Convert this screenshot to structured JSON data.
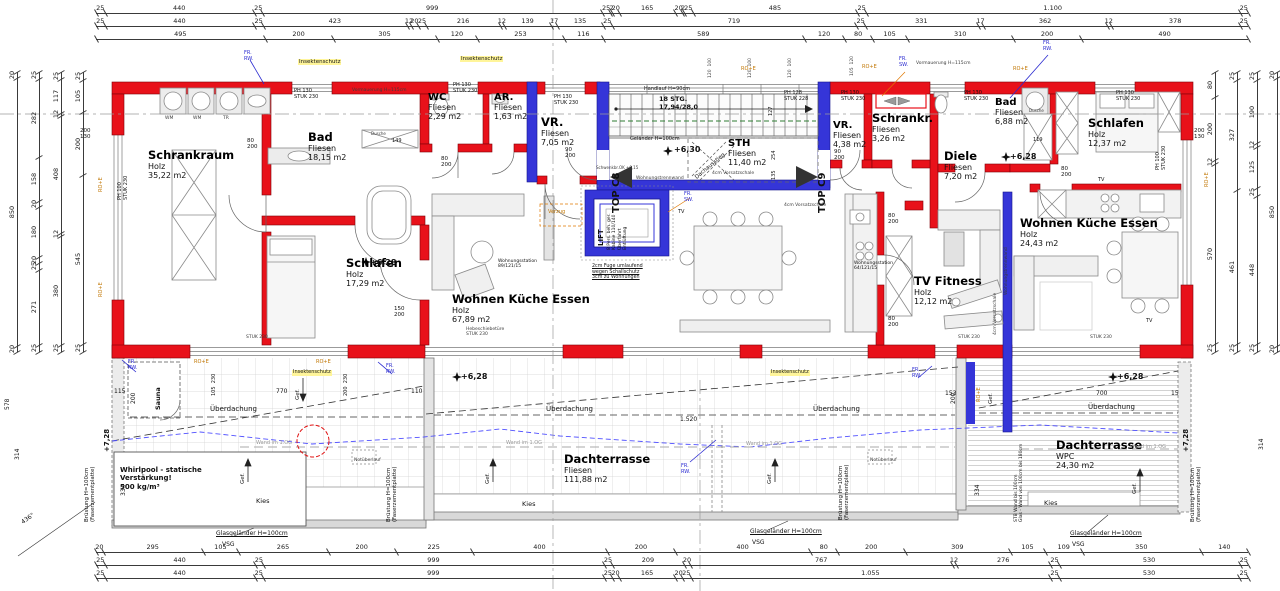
{
  "drawing": {
    "kind": "architectural floor plan",
    "units": [
      "TOP C8",
      "TOP C9"
    ]
  },
  "rooms": [
    {
      "name": "Schrankraum",
      "material": "Holz",
      "area": "35,22 m2",
      "x": 148,
      "y": 148
    },
    {
      "name": "Bad",
      "material": "Fliesen",
      "area": "18,15 m2",
      "x": 308,
      "y": 130
    },
    {
      "name": "WC",
      "material": "Fliesen",
      "area": "2,29 m2",
      "x": 428,
      "y": 92,
      "small": true
    },
    {
      "name": "AR.",
      "material": "Fliesen",
      "area": "1,63 m2",
      "x": 494,
      "y": 92,
      "small": true
    },
    {
      "name": "VR.",
      "material": "Fliesen",
      "area": "7,05 m2",
      "x": 541,
      "y": 115
    },
    {
      "name": "Schlafen",
      "material": "Holz",
      "area": "17,29 m2",
      "x": 346,
      "y": 256
    },
    {
      "name": "Wohnen Küche Essen",
      "material": "Holz",
      "area": "67,89 m2",
      "x": 452,
      "y": 292
    },
    {
      "name": "STH",
      "material": "Fliesen",
      "area": "11,40 m2",
      "x": 728,
      "y": 138,
      "small": true
    },
    {
      "name": "VR.",
      "material": "Fliesen",
      "area": "4,38 m2",
      "x": 833,
      "y": 120,
      "small": true
    },
    {
      "name": "Schrankr.",
      "material": "Fliesen",
      "area": "3,26 m2",
      "x": 872,
      "y": 111
    },
    {
      "name": "Bad",
      "material": "Fliesen",
      "area": "6,88 m2",
      "x": 995,
      "y": 97,
      "small": true
    },
    {
      "name": "Diele",
      "material": "Fliesen",
      "area": "7,20 m2",
      "x": 944,
      "y": 149
    },
    {
      "name": "Schlafen",
      "material": "Holz",
      "area": "12,37 m2",
      "x": 1088,
      "y": 116
    },
    {
      "name": "Wohnen Küche Essen",
      "material": "Holz",
      "area": "24,43 m2",
      "x": 1020,
      "y": 216
    },
    {
      "name": "TV Fitness",
      "material": "Holz",
      "area": "12,12 m2",
      "x": 914,
      "y": 274
    },
    {
      "name": "Dachterrasse",
      "material": "Fliesen",
      "area": "111,88 m2",
      "x": 564,
      "y": 452
    },
    {
      "name": "Dachterrasse",
      "material": "WPC",
      "area": "24,30 m2",
      "x": 1056,
      "y": 438
    }
  ],
  "labels": [
    {
      "t": "FR.\nRW.",
      "x": 244,
      "y": 51,
      "s": 5,
      "c": "blue"
    },
    {
      "t": "FR.\nRW.",
      "x": 1043,
      "y": 41,
      "s": 5,
      "c": "blue"
    },
    {
      "t": "FR.\nSW.",
      "x": 899,
      "y": 57,
      "s": 5,
      "c": "blue"
    },
    {
      "t": "FR.\nSW.",
      "x": 684,
      "y": 192,
      "s": 5,
      "c": "blue"
    },
    {
      "t": "RO+E",
      "x": 741,
      "y": 67,
      "s": 5,
      "c": "orange"
    },
    {
      "t": "RO+E",
      "x": 862,
      "y": 65,
      "s": 5,
      "c": "orange"
    },
    {
      "t": "RO+E",
      "x": 1013,
      "y": 67,
      "s": 5,
      "c": "orange"
    },
    {
      "t": "Insektenschutz",
      "x": 298,
      "y": 59,
      "s": 5.5,
      "c": "yellow"
    },
    {
      "t": "Insektenschutz",
      "x": 460,
      "y": 56,
      "s": 5.5,
      "c": "yellow"
    },
    {
      "t": "Vormauerung H=115cm",
      "x": 352,
      "y": 88,
      "s": 4.5,
      "c": "dim"
    },
    {
      "t": "Vormauerung H=115cm",
      "x": 916,
      "y": 61,
      "s": 4.5,
      "c": "dim"
    },
    {
      "t": "PH 130\nSTUK 230",
      "x": 294,
      "y": 89,
      "s": 5
    },
    {
      "t": "PH 130\nSTUK 230",
      "x": 453,
      "y": 83,
      "s": 5
    },
    {
      "t": "PH 130\nSTUK 230",
      "x": 554,
      "y": 95,
      "s": 5
    },
    {
      "t": "PH 128\nSTUK 228",
      "x": 784,
      "y": 91,
      "s": 5
    },
    {
      "t": "PH 130\nSTUK 230",
      "x": 841,
      "y": 91,
      "s": 5
    },
    {
      "t": "PH 130\nSTUK 230",
      "x": 964,
      "y": 91,
      "s": 5
    },
    {
      "t": "PH 130\nSTUK 230",
      "x": 1116,
      "y": 91,
      "s": 5
    },
    {
      "t": "PH 100\nSTUK 230",
      "x": 118,
      "y": 200,
      "r": -90,
      "s": 5
    },
    {
      "t": "PH 100\nSTUK 230",
      "x": 1156,
      "y": 170,
      "r": -90,
      "s": 5
    },
    {
      "t": "120  100",
      "x": 708,
      "y": 78,
      "r": -90,
      "s": 4.5,
      "c": "dim"
    },
    {
      "t": "120  100",
      "x": 748,
      "y": 78,
      "r": -90,
      "s": 4.5,
      "c": "dim"
    },
    {
      "t": "120  100",
      "x": 788,
      "y": 78,
      "r": -90,
      "s": 4.5,
      "c": "dim"
    },
    {
      "t": "105  120",
      "x": 850,
      "y": 76,
      "r": -90,
      "s": 4.5,
      "c": "dim"
    },
    {
      "t": "Handlauf H=90cm",
      "x": 644,
      "y": 87,
      "s": 5
    },
    {
      "t": "18 STG.\n17,94/28,0",
      "x": 659,
      "y": 96,
      "s": 6.5,
      "c": "bold"
    },
    {
      "t": "Geländer H=100cm",
      "x": 630,
      "y": 137,
      "s": 5
    },
    {
      "t": "+6,30",
      "x": 674,
      "y": 145,
      "s": 8,
      "c": "bold"
    },
    {
      "t": "TOP C8",
      "x": 611,
      "y": 213,
      "r": -90,
      "s": 10,
      "c": "bold"
    },
    {
      "t": "TOP C9",
      "x": 817,
      "y": 213,
      "r": -90,
      "s": 10,
      "c": "bold"
    },
    {
      "t": "127",
      "x": 769,
      "y": 116,
      "r": -90,
      "s": 5
    },
    {
      "t": "254",
      "x": 772,
      "y": 160,
      "r": -90,
      "s": 5
    },
    {
      "t": "135",
      "x": 772,
      "y": 180,
      "r": -90,
      "s": 5
    },
    {
      "t": "Dachausstieg",
      "x": 694,
      "y": 176,
      "r": -40,
      "s": 5.5
    },
    {
      "t": "Schwenkbr.OK +0,15",
      "x": 596,
      "y": 166,
      "s": 4,
      "c": "dim"
    },
    {
      "t": "LIFT",
      "x": 597,
      "y": 246,
      "r": -90,
      "s": 7,
      "c": "bold"
    },
    {
      "t": "8 Pers. beh. ger.\nKabine 110/140\nÜberfahrt\nEntlüftung",
      "x": 607,
      "y": 250,
      "r": -90,
      "s": 4.5
    },
    {
      "t": "2cm Fuge umlaufend\nwegen Schallschutz\n3cm zu Wohnungen",
      "x": 592,
      "y": 264,
      "s": 4.8,
      "c": "ul"
    },
    {
      "t": "Wohnungstrennwand",
      "x": 636,
      "y": 176,
      "s": 4.5,
      "c": "dim"
    },
    {
      "t": "Wohnungstrennwand",
      "x": 1004,
      "y": 295,
      "r": -90,
      "s": 4.5,
      "c": "dim"
    },
    {
      "t": "4cm Vorsatzschale",
      "x": 712,
      "y": 171,
      "s": 4.5,
      "c": "dim"
    },
    {
      "t": "4cm Vorsatzschale",
      "x": 784,
      "y": 203,
      "s": 4.5,
      "c": "dim"
    },
    {
      "t": "4cm Vorsatzschale",
      "x": 993,
      "y": 335,
      "r": -90,
      "s": 4.5,
      "c": "dim"
    },
    {
      "t": "Verzug",
      "x": 548,
      "y": 210,
      "s": 5,
      "c": "orange"
    },
    {
      "t": "TV",
      "x": 678,
      "y": 210,
      "s": 5
    },
    {
      "t": "TV",
      "x": 1098,
      "y": 178,
      "s": 5
    },
    {
      "t": "TV",
      "x": 1146,
      "y": 319,
      "s": 5
    },
    {
      "t": "Hebeschiebetüre\nSTUK 230",
      "x": 466,
      "y": 327,
      "s": 4.5,
      "c": "dim"
    },
    {
      "t": "STUK 230",
      "x": 246,
      "y": 335,
      "s": 4.5,
      "c": "dim"
    },
    {
      "t": "STUK 230",
      "x": 958,
      "y": 335,
      "s": 4.5,
      "c": "dim"
    },
    {
      "t": "STUK 230",
      "x": 1090,
      "y": 335,
      "s": 4.5,
      "c": "dim"
    },
    {
      "t": "Wohnungsstation\n89/121/15",
      "x": 498,
      "y": 259,
      "s": 4.5
    },
    {
      "t": "Wohnungsstation\n64/121/15",
      "x": 854,
      "y": 261,
      "s": 4.5
    },
    {
      "t": "Dusche",
      "x": 371,
      "y": 132,
      "s": 4,
      "c": "dim"
    },
    {
      "t": "149",
      "x": 392,
      "y": 139,
      "s": 5
    },
    {
      "t": "Dusche",
      "x": 1029,
      "y": 109,
      "s": 4,
      "c": "dim"
    },
    {
      "t": "119",
      "x": 1033,
      "y": 138,
      "s": 5
    },
    {
      "t": "80\n200",
      "x": 247,
      "y": 138,
      "s": 5.5
    },
    {
      "t": "80\n200",
      "x": 441,
      "y": 156,
      "s": 5.5
    },
    {
      "t": "90\n200",
      "x": 565,
      "y": 147,
      "s": 5.5
    },
    {
      "t": "90\n200",
      "x": 834,
      "y": 149,
      "s": 5.5
    },
    {
      "t": "80\n200",
      "x": 1061,
      "y": 166,
      "s": 5.5
    },
    {
      "t": "80\n200",
      "x": 888,
      "y": 213,
      "s": 5.5
    },
    {
      "t": "80\n200",
      "x": 888,
      "y": 316,
      "s": 5.5
    },
    {
      "t": "150\n200",
      "x": 394,
      "y": 306,
      "s": 5.5
    },
    {
      "t": "+6,28",
      "x": 370,
      "y": 258,
      "s": 8,
      "c": "bold"
    },
    {
      "t": "+6,28",
      "x": 461,
      "y": 372,
      "s": 8,
      "c": "bold"
    },
    {
      "t": "+6,28",
      "x": 1117,
      "y": 372,
      "s": 8,
      "c": "bold"
    },
    {
      "t": "+6,28",
      "x": 1010,
      "y": 152,
      "s": 8,
      "c": "bold"
    },
    {
      "t": "+7,28",
      "x": 103,
      "y": 452,
      "r": -90,
      "s": 7,
      "c": "bold"
    },
    {
      "t": "+7,28",
      "x": 1182,
      "y": 452,
      "r": -90,
      "s": 7,
      "c": "bold"
    },
    {
      "t": "Sauna",
      "x": 155,
      "y": 410,
      "r": -90,
      "s": 6.5,
      "c": "bold"
    },
    {
      "t": "Whirlpool - statische\nVerstärkung!\n500 kg/m³",
      "x": 120,
      "y": 466,
      "s": 7,
      "c": "bold"
    },
    {
      "t": "Überdachung",
      "x": 210,
      "y": 405,
      "s": 7
    },
    {
      "t": "Überdachung",
      "x": 546,
      "y": 405,
      "s": 7
    },
    {
      "t": "Überdachung",
      "x": 813,
      "y": 405,
      "s": 7
    },
    {
      "t": "Überdachung",
      "x": 1088,
      "y": 403,
      "s": 7
    },
    {
      "t": "Wand im 1.OG",
      "x": 256,
      "y": 441,
      "s": 5,
      "c": "gray"
    },
    {
      "t": "Wand im 1.OG",
      "x": 506,
      "y": 441,
      "s": 5,
      "c": "gray"
    },
    {
      "t": "Wand im 1.OG",
      "x": 746,
      "y": 442,
      "s": 5,
      "c": "gray"
    },
    {
      "t": "Wand im 1.OG",
      "x": 1130,
      "y": 445,
      "s": 5,
      "c": "gray"
    },
    {
      "t": "Kies",
      "x": 256,
      "y": 498,
      "s": 6.5
    },
    {
      "t": "Kies",
      "x": 522,
      "y": 501,
      "s": 6.5
    },
    {
      "t": "Kies",
      "x": 1044,
      "y": 500,
      "s": 6.5
    },
    {
      "t": "Glasgeländer H=100cm",
      "x": 216,
      "y": 530,
      "s": 6,
      "c": "ul"
    },
    {
      "t": "VSG",
      "x": 222,
      "y": 541,
      "s": 6
    },
    {
      "t": "Glasgeländer H=100cm",
      "x": 750,
      "y": 528,
      "s": 6,
      "c": "ul"
    },
    {
      "t": "VSG",
      "x": 752,
      "y": 539,
      "s": 6
    },
    {
      "t": "Glasgeländer H=100cm",
      "x": 1070,
      "y": 530,
      "s": 6,
      "c": "ul"
    },
    {
      "t": "VSG",
      "x": 1072,
      "y": 541,
      "s": 6
    },
    {
      "t": "Brüstung H=100cm\n(Faserzementplatte)",
      "x": 84,
      "y": 522,
      "r": -90,
      "s": 5.5
    },
    {
      "t": "Brüstung H=100cm\n(Faserzementplatte)",
      "x": 386,
      "y": 522,
      "r": -90,
      "s": 5.5
    },
    {
      "t": "Brüstung H=100cm\n(Faserzementplatte)",
      "x": 838,
      "y": 520,
      "r": -90,
      "s": 5.5
    },
    {
      "t": "Brüstung H=100cm\n(Faserzementplatte)",
      "x": 1190,
      "y": 522,
      "r": -90,
      "s": 5.5
    },
    {
      "t": "STB Wand bis 100cm\nGlas - Wand von 100cm bis 180cm",
      "x": 1014,
      "y": 522,
      "r": -90,
      "s": 4.5
    },
    {
      "t": "Notüberlauf",
      "x": 354,
      "y": 458,
      "s": 4.5,
      "c": "dim"
    },
    {
      "t": "Notüberlauf",
      "x": 870,
      "y": 458,
      "s": 4.5,
      "c": "dim"
    },
    {
      "t": "FR.\nRW.",
      "x": 128,
      "y": 360,
      "s": 5,
      "c": "blue"
    },
    {
      "t": "FR.\nRW.",
      "x": 386,
      "y": 364,
      "s": 5,
      "c": "blue"
    },
    {
      "t": "FR.\nRW.",
      "x": 912,
      "y": 368,
      "s": 5,
      "c": "blue"
    },
    {
      "t": "FR.\nRW.",
      "x": 681,
      "y": 464,
      "s": 5,
      "c": "blue"
    },
    {
      "t": "RO+E",
      "x": 194,
      "y": 360,
      "s": 5,
      "c": "orange"
    },
    {
      "t": "RO+E",
      "x": 316,
      "y": 360,
      "s": 5,
      "c": "orange"
    },
    {
      "t": "RO+E",
      "x": 977,
      "y": 402,
      "r": -90,
      "s": 5,
      "c": "orange"
    },
    {
      "t": "RO+E",
      "x": 99,
      "y": 192,
      "r": -90,
      "s": 5,
      "c": "orange"
    },
    {
      "t": "RO+E",
      "x": 99,
      "y": 297,
      "r": -90,
      "s": 5,
      "c": "orange"
    },
    {
      "t": "RO+E",
      "x": 1205,
      "y": 187,
      "r": -90,
      "s": 5,
      "c": "orange"
    },
    {
      "t": "Insektenschutz",
      "x": 292,
      "y": 370,
      "s": 5,
      "c": "yellow"
    },
    {
      "t": "Insektenschutz",
      "x": 770,
      "y": 370,
      "s": 5,
      "c": "yellow"
    },
    {
      "t": "Gef.",
      "x": 295,
      "y": 400,
      "r": -90,
      "s": 5.5
    },
    {
      "t": "Gef.",
      "x": 240,
      "y": 484,
      "r": -90,
      "s": 5.5
    },
    {
      "t": "Gef.",
      "x": 485,
      "y": 484,
      "r": -90,
      "s": 5.5
    },
    {
      "t": "Gef.",
      "x": 767,
      "y": 484,
      "r": -90,
      "s": 5.5
    },
    {
      "t": "Gef.",
      "x": 1132,
      "y": 494,
      "r": -90,
      "s": 5.5
    },
    {
      "t": "Gef.",
      "x": 988,
      "y": 404,
      "r": -90,
      "s": 5.5
    },
    {
      "t": "115",
      "x": 114,
      "y": 388,
      "s": 6
    },
    {
      "t": "770",
      "x": 276,
      "y": 388,
      "s": 6
    },
    {
      "t": "110",
      "x": 411,
      "y": 388,
      "s": 6
    },
    {
      "t": "1.520",
      "x": 680,
      "y": 416,
      "s": 6
    },
    {
      "t": "153",
      "x": 945,
      "y": 390,
      "s": 6
    },
    {
      "t": "700",
      "x": 1096,
      "y": 390,
      "s": 6
    },
    {
      "t": "15",
      "x": 1171,
      "y": 390,
      "s": 6
    },
    {
      "t": "334",
      "x": 120,
      "y": 496,
      "r": -90,
      "s": 6
    },
    {
      "t": "334",
      "x": 974,
      "y": 496,
      "r": -90,
      "s": 6
    },
    {
      "t": "200",
      "x": 130,
      "y": 404,
      "r": -90,
      "s": 6
    },
    {
      "t": "200",
      "x": 950,
      "y": 404,
      "r": -90,
      "s": 6
    },
    {
      "t": "105  230",
      "x": 212,
      "y": 396,
      "r": -90,
      "s": 5
    },
    {
      "t": "200  230",
      "x": 344,
      "y": 396,
      "r": -90,
      "s": 5
    },
    {
      "t": "578",
      "x": 4,
      "y": 410,
      "r": -90,
      "s": 6
    },
    {
      "t": "314",
      "x": 14,
      "y": 460,
      "r": -90,
      "s": 6
    },
    {
      "t": "314",
      "x": 1258,
      "y": 450,
      "r": -90,
      "s": 6
    },
    {
      "t": "436°",
      "x": 20,
      "y": 520,
      "r": -35,
      "s": 6
    },
    {
      "t": "200\n130",
      "x": 80,
      "y": 128,
      "s": 5.5
    },
    {
      "t": "200\n130",
      "x": 1194,
      "y": 128,
      "s": 5.5
    },
    {
      "t": "WM",
      "x": 165,
      "y": 116,
      "s": 4.5,
      "c": "dim"
    },
    {
      "t": "WM",
      "x": 193,
      "y": 116,
      "s": 4.5,
      "c": "dim"
    },
    {
      "t": "TR",
      "x": 223,
      "y": 116,
      "s": 4.5,
      "c": "dim"
    }
  ],
  "dims": {
    "h": [
      {
        "x": 96,
        "y": 2,
        "w": 1152,
        "values": [
          "25",
          "440",
          "25",
          "999",
          "25",
          "2",
          "20",
          "165",
          "20",
          "2",
          "25",
          "485",
          "25",
          "1.100",
          "25"
        ]
      },
      {
        "x": 96,
        "y": 15,
        "w": 1152,
        "values": [
          "25",
          "440",
          "25",
          "423",
          "12",
          "20",
          "25",
          "216",
          "12",
          "139",
          "17",
          "135",
          "25",
          "719",
          "25",
          "331",
          "17",
          "362",
          "12",
          "378",
          "25"
        ]
      },
      {
        "x": 96,
        "y": 28,
        "w": 1152,
        "values": [
          "495",
          "200",
          "305",
          "120",
          "253",
          "116",
          "589",
          "120",
          "80",
          "105",
          "310",
          "200",
          "490"
        ]
      },
      {
        "x": 96,
        "y": 541,
        "w": 1152,
        "values": [
          "20",
          "295",
          "105",
          "265",
          "200",
          "225",
          "400",
          "200",
          "400",
          "80",
          "200",
          "309",
          "105",
          "109",
          "350",
          "140"
        ]
      },
      {
        "x": 96,
        "y": 554,
        "w": 1152,
        "values": [
          "25",
          "440",
          "25",
          "999",
          "25",
          "209",
          "20",
          "767",
          "12",
          "276",
          "25",
          "530",
          "25"
        ]
      },
      {
        "x": 96,
        "y": 567,
        "w": 1152,
        "values": [
          "25",
          "440",
          "25",
          "999",
          "25",
          "20",
          "165",
          "20",
          "25",
          "1.055",
          "25",
          "530",
          "25"
        ]
      }
    ],
    "v": [
      {
        "x": 6,
        "y": 72,
        "h": 280,
        "values": [
          "20",
          "850",
          "20"
        ]
      },
      {
        "x": 28,
        "y": 72,
        "h": 280,
        "values": [
          "25",
          "282",
          "158",
          "20",
          "180",
          "20",
          "25",
          "271",
          "25"
        ]
      },
      {
        "x": 50,
        "y": 72,
        "h": 280,
        "values": [
          "25",
          "117",
          "12",
          "408",
          "12",
          "380",
          "25"
        ]
      },
      {
        "x": 72,
        "y": 72,
        "h": 280,
        "values": [
          "25",
          "105",
          "200",
          "545",
          "25"
        ]
      },
      {
        "x": 1204,
        "y": 72,
        "h": 280,
        "values": [
          "80",
          "200",
          "12",
          "570",
          "25"
        ]
      },
      {
        "x": 1226,
        "y": 72,
        "h": 280,
        "values": [
          "25",
          "327",
          "461",
          "25"
        ]
      },
      {
        "x": 1246,
        "y": 72,
        "h": 280,
        "values": [
          "25",
          "190",
          "12",
          "125",
          "25",
          "448",
          "25"
        ]
      },
      {
        "x": 1266,
        "y": 72,
        "h": 280,
        "values": [
          "20",
          "850",
          "20"
        ]
      }
    ]
  },
  "colors": {
    "wall_red": "#e8111a",
    "wall_blue": "#3535d8",
    "highlight_yellow": "#fff59a",
    "level_green": "#2e7d32"
  }
}
